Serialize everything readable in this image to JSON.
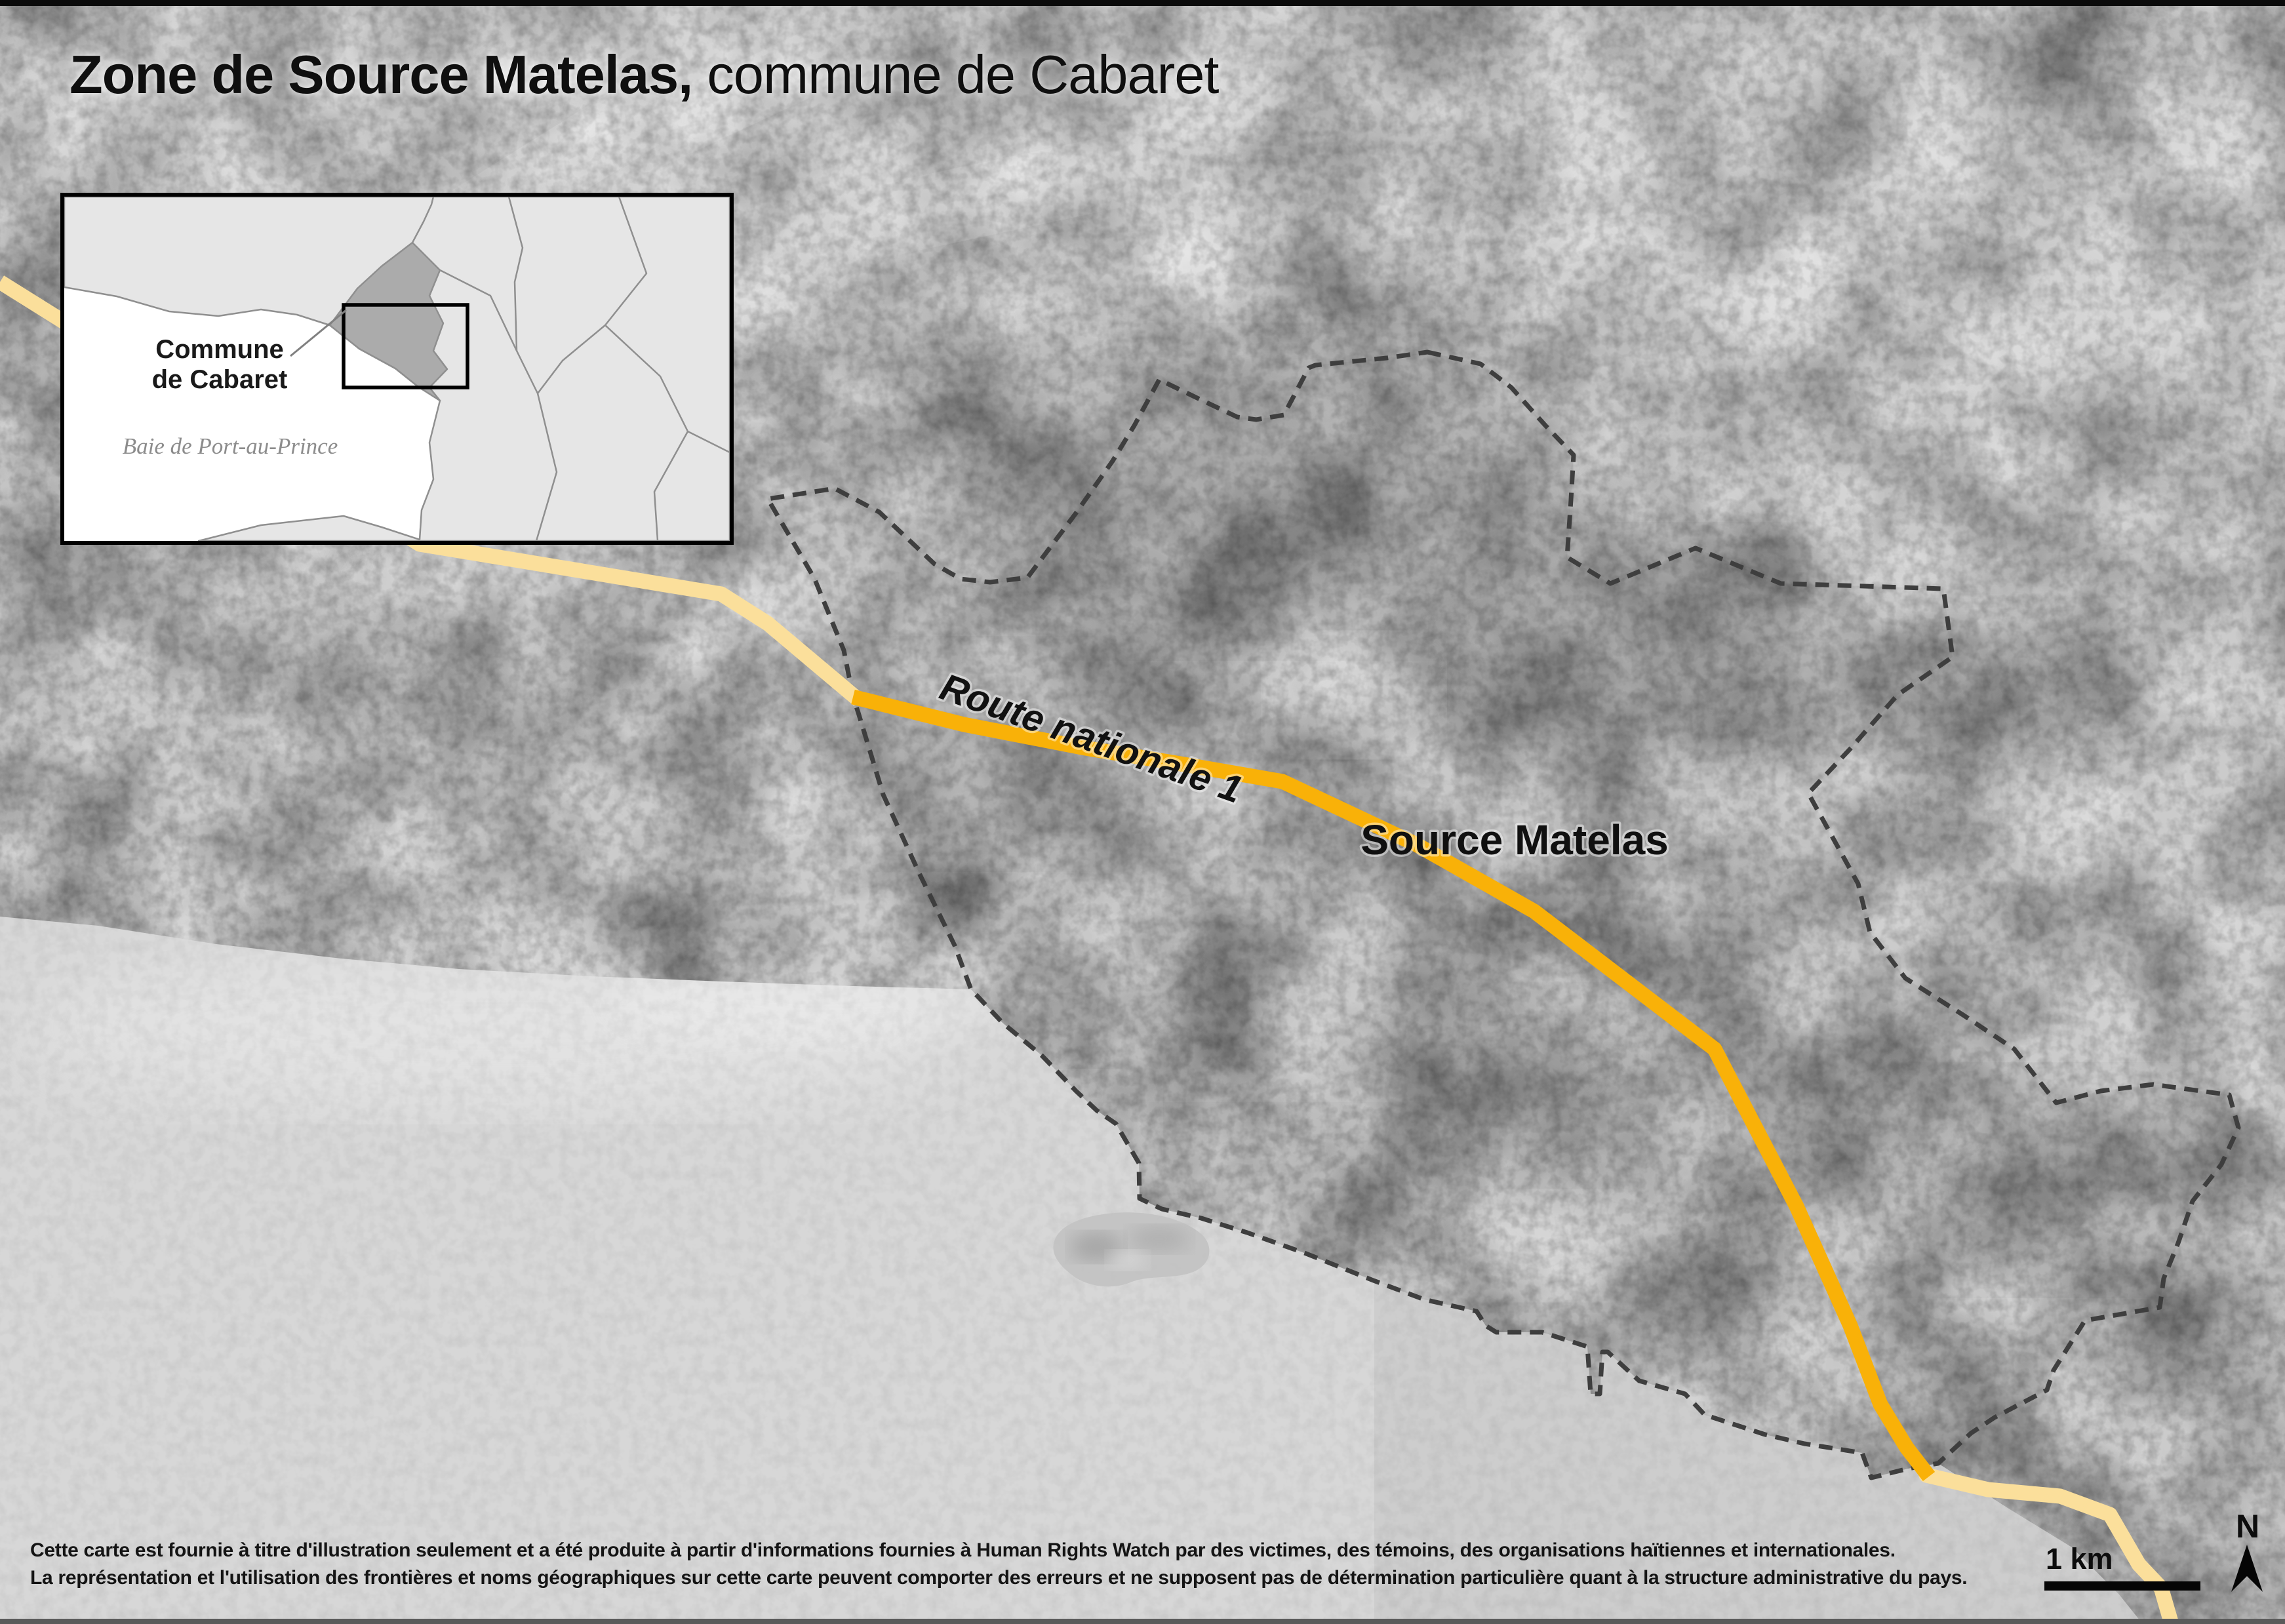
{
  "title": {
    "bold": "Zone de Source Matelas,",
    "regular": " commune de Cabaret"
  },
  "inset": {
    "commune_line1": "Commune",
    "commune_line2": "de Cabaret",
    "bay": "Baie de Port-au-Prince"
  },
  "map": {
    "zone_label": "Source Matelas",
    "road_label": "Route nationale 1"
  },
  "scale": {
    "label": "1 km"
  },
  "compass": {
    "label": "N"
  },
  "footer": {
    "line1": "Cette carte est fournie à titre d'illustration seulement et a été produite à partir d'informations fournies à Human Rights Watch par des victimes, des témoins, des organisations haïtiennes et internationales.",
    "line2": "La représentation et l'utilisation des frontières et noms géographiques sur cette carte peuvent comporter des erreurs et ne supposent pas de détermination particulière quant à la structure administrative du pays."
  },
  "colors": {
    "land": "#cbcbcb",
    "sea": "#d7d7d7",
    "boundary": "#3e3e3e",
    "road_primary": "#f9b108",
    "road_secondary": "#fbdf9b",
    "inset_land": "#e6e6e6",
    "inset_commune": "#ababab",
    "inset_border_lines": "#8f8f8f"
  }
}
